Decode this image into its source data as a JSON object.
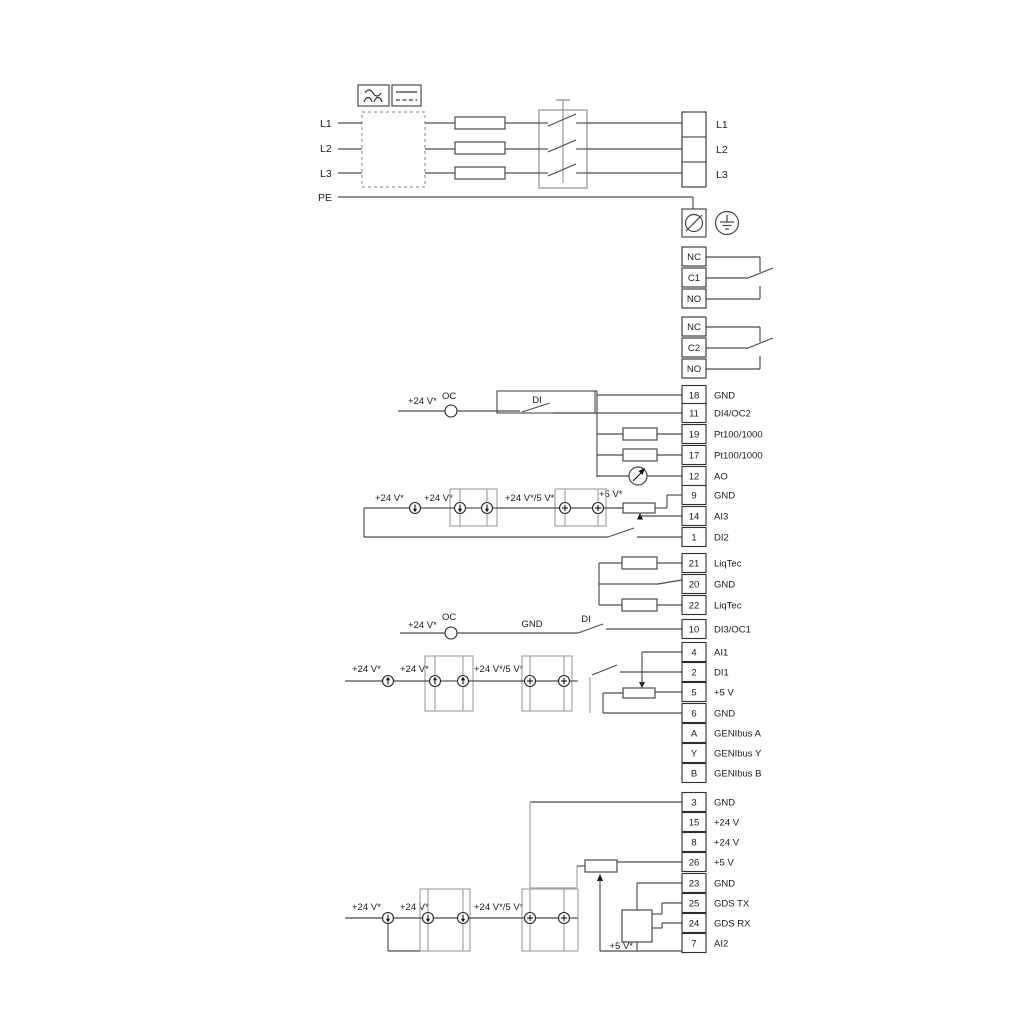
{
  "power": {
    "inputs": [
      "L1",
      "L2",
      "L3",
      "PE"
    ],
    "outputs": [
      "L1",
      "L2",
      "L3"
    ]
  },
  "relays": [
    {
      "terminals": [
        "NC",
        "C1",
        "NO"
      ]
    },
    {
      "terminals": [
        "NC",
        "C2",
        "NO"
      ]
    }
  ],
  "strips": [
    {
      "terminals": [
        {
          "pin": "18",
          "label": "GND"
        },
        {
          "pin": "11",
          "label": "DI4/OC2"
        },
        {
          "pin": "19",
          "label": "Pt100/1000"
        },
        {
          "pin": "17",
          "label": "Pt100/1000"
        },
        {
          "pin": "12",
          "label": "AO"
        },
        {
          "pin": "9",
          "label": "GND"
        },
        {
          "pin": "14",
          "label": "AI3"
        },
        {
          "pin": "1",
          "label": "DI2"
        }
      ]
    },
    {
      "terminals": [
        {
          "pin": "21",
          "label": "LiqTec"
        },
        {
          "pin": "20",
          "label": "GND"
        },
        {
          "pin": "22",
          "label": "LiqTec"
        }
      ]
    },
    {
      "terminals": [
        {
          "pin": "10",
          "label": "DI3/OC1"
        },
        {
          "pin": "4",
          "label": "AI1"
        },
        {
          "pin": "2",
          "label": "DI1"
        },
        {
          "pin": "5",
          "label": "+5 V"
        },
        {
          "pin": "6",
          "label": "GND"
        },
        {
          "pin": "A",
          "label": "GENIbus A"
        },
        {
          "pin": "Y",
          "label": "GENIbus Y"
        },
        {
          "pin": "B",
          "label": "GENIbus B"
        }
      ]
    },
    {
      "terminals": [
        {
          "pin": "3",
          "label": "GND"
        },
        {
          "pin": "15",
          "label": "+24 V"
        },
        {
          "pin": "8",
          "label": "+24 V"
        },
        {
          "pin": "26",
          "label": "+5 V"
        },
        {
          "pin": "23",
          "label": "GND"
        },
        {
          "pin": "25",
          "label": "GDS TX"
        },
        {
          "pin": "24",
          "label": "GDS RX"
        },
        {
          "pin": "7",
          "label": "AI2"
        }
      ]
    }
  ],
  "labels": {
    "v24": "+24 V*",
    "v24v5": "+24 V*/5 V*",
    "v5": "+5 V*",
    "oc": "OC",
    "di": "DI",
    "gnd": "GND"
  },
  "symbols": {
    "ac_filter": "~",
    "dc_filter": "=",
    "protective_earth": "earth",
    "screw_terminal": "screw"
  }
}
